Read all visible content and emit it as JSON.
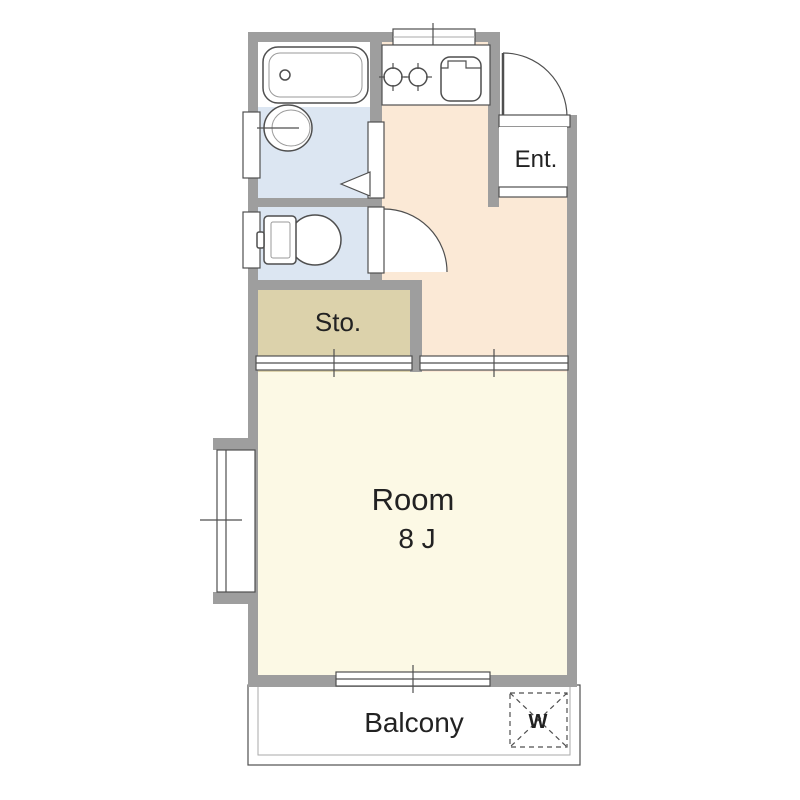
{
  "floor_plan": {
    "rooms": {
      "entrance": {
        "label": "Ent."
      },
      "main_room": {
        "label": "Room",
        "size": "8 J"
      },
      "storage": {
        "label": "Sto."
      },
      "balcony": {
        "label": "Balcony",
        "washer_mark": "W"
      }
    },
    "colors": {
      "wall": "#9e9e9e",
      "outline": "#4f4f4f",
      "bathroom_floor": "#dce6f2",
      "kitchen_floor": "#fbe9d6",
      "storage_floor": "#dcd2ab",
      "room_floor": "#fcf9e5",
      "text": "#222222"
    }
  }
}
